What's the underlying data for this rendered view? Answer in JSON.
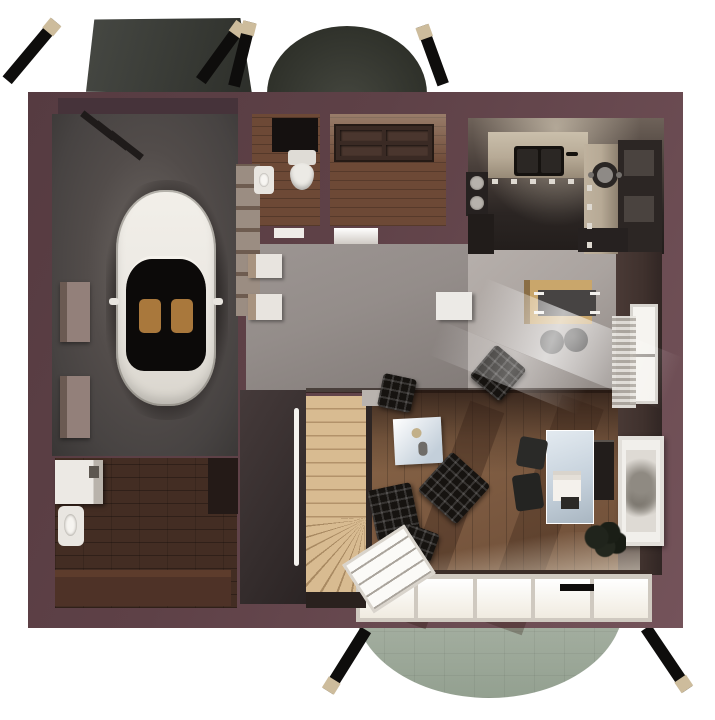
{
  "meta": {
    "description": "3D top-down architectural floor plan rendering of a ground floor: garage with white car, bathroom, entry with front door, kitchen, open hall and dining area, living room with lounge chairs and french windows, utility room, winder staircase, garage canopy, domed entrance roof and rear semicircular patio",
    "image_type": "architectural 3D floor plan render",
    "visible_text": ""
  },
  "palette": {
    "background": "#ffffff",
    "wall": "#5e4147",
    "wall-light": "#74535a",
    "wall-dark": "#46333a",
    "roof-canopy": "#3b3d38",
    "roof-dome": "#34362f",
    "strut-black": "#0e0d0c",
    "strut-tip": "#cdbc9c",
    "patio": "#a9b3a5",
    "garage-floor": "#474342",
    "car-body": "#ece9e3",
    "car-glass": "#0c0a09",
    "car-seat": "#a9783c",
    "wood-floor": "#6d4936",
    "utility-floor": "#432d23",
    "hall-floor": "#948d8a",
    "dining-floor": "#aaa39f",
    "living-floor": "#7b5940",
    "stair-wood": "#d8bb91",
    "kitchen-counter": "#b7aa96",
    "kitchen-dark": "#2b2523",
    "inner-wall": "#3f312d",
    "window-white": "#f6f4f0",
    "tufted-black": "#161310",
    "glass-blue": "#c3cfda",
    "frame-white": "#f1efeb"
  },
  "scene": {
    "rooms": [
      {
        "name": "Garage",
        "furniture": [
          "white car",
          "wall shelves",
          "storage niches",
          "vent slats"
        ]
      },
      {
        "name": "Bathroom",
        "furniture": [
          "toilet",
          "wash basin",
          "mirror panel"
        ]
      },
      {
        "name": "Entry",
        "furniture": [
          "panelled front door"
        ]
      },
      {
        "name": "Kitchen",
        "furniture": [
          "double sink",
          "counter",
          "pot on cooktop",
          "fridge",
          "wall units",
          "sideboard"
        ]
      },
      {
        "name": "Hall",
        "furniture": [
          "wall boxes",
          "white cabinet",
          "side table",
          "sun rays"
        ]
      },
      {
        "name": "Dining area",
        "furniture": [
          "wood table",
          "dark table top",
          "two stools",
          "tufted armchair",
          "window",
          "radiator"
        ]
      },
      {
        "name": "Living room",
        "furniture": [
          "blue side table",
          "two tufted lounge chairs",
          "ottoman",
          "tufted armchair",
          "glass desk",
          "desk chairs",
          "shelf",
          "plant",
          "picture frame",
          "french windows",
          "open window pane"
        ]
      },
      {
        "name": "Utility room",
        "furniture": [
          "washing machine",
          "sink",
          "bench"
        ]
      },
      {
        "name": "Staircase",
        "furniture": [
          "straight treads",
          "winder treads",
          "handrail light strip"
        ]
      }
    ],
    "exterior": [
      "garage canopy",
      "entrance dome roof",
      "rear semicircular patio",
      "black support struts with wooden tips"
    ]
  }
}
